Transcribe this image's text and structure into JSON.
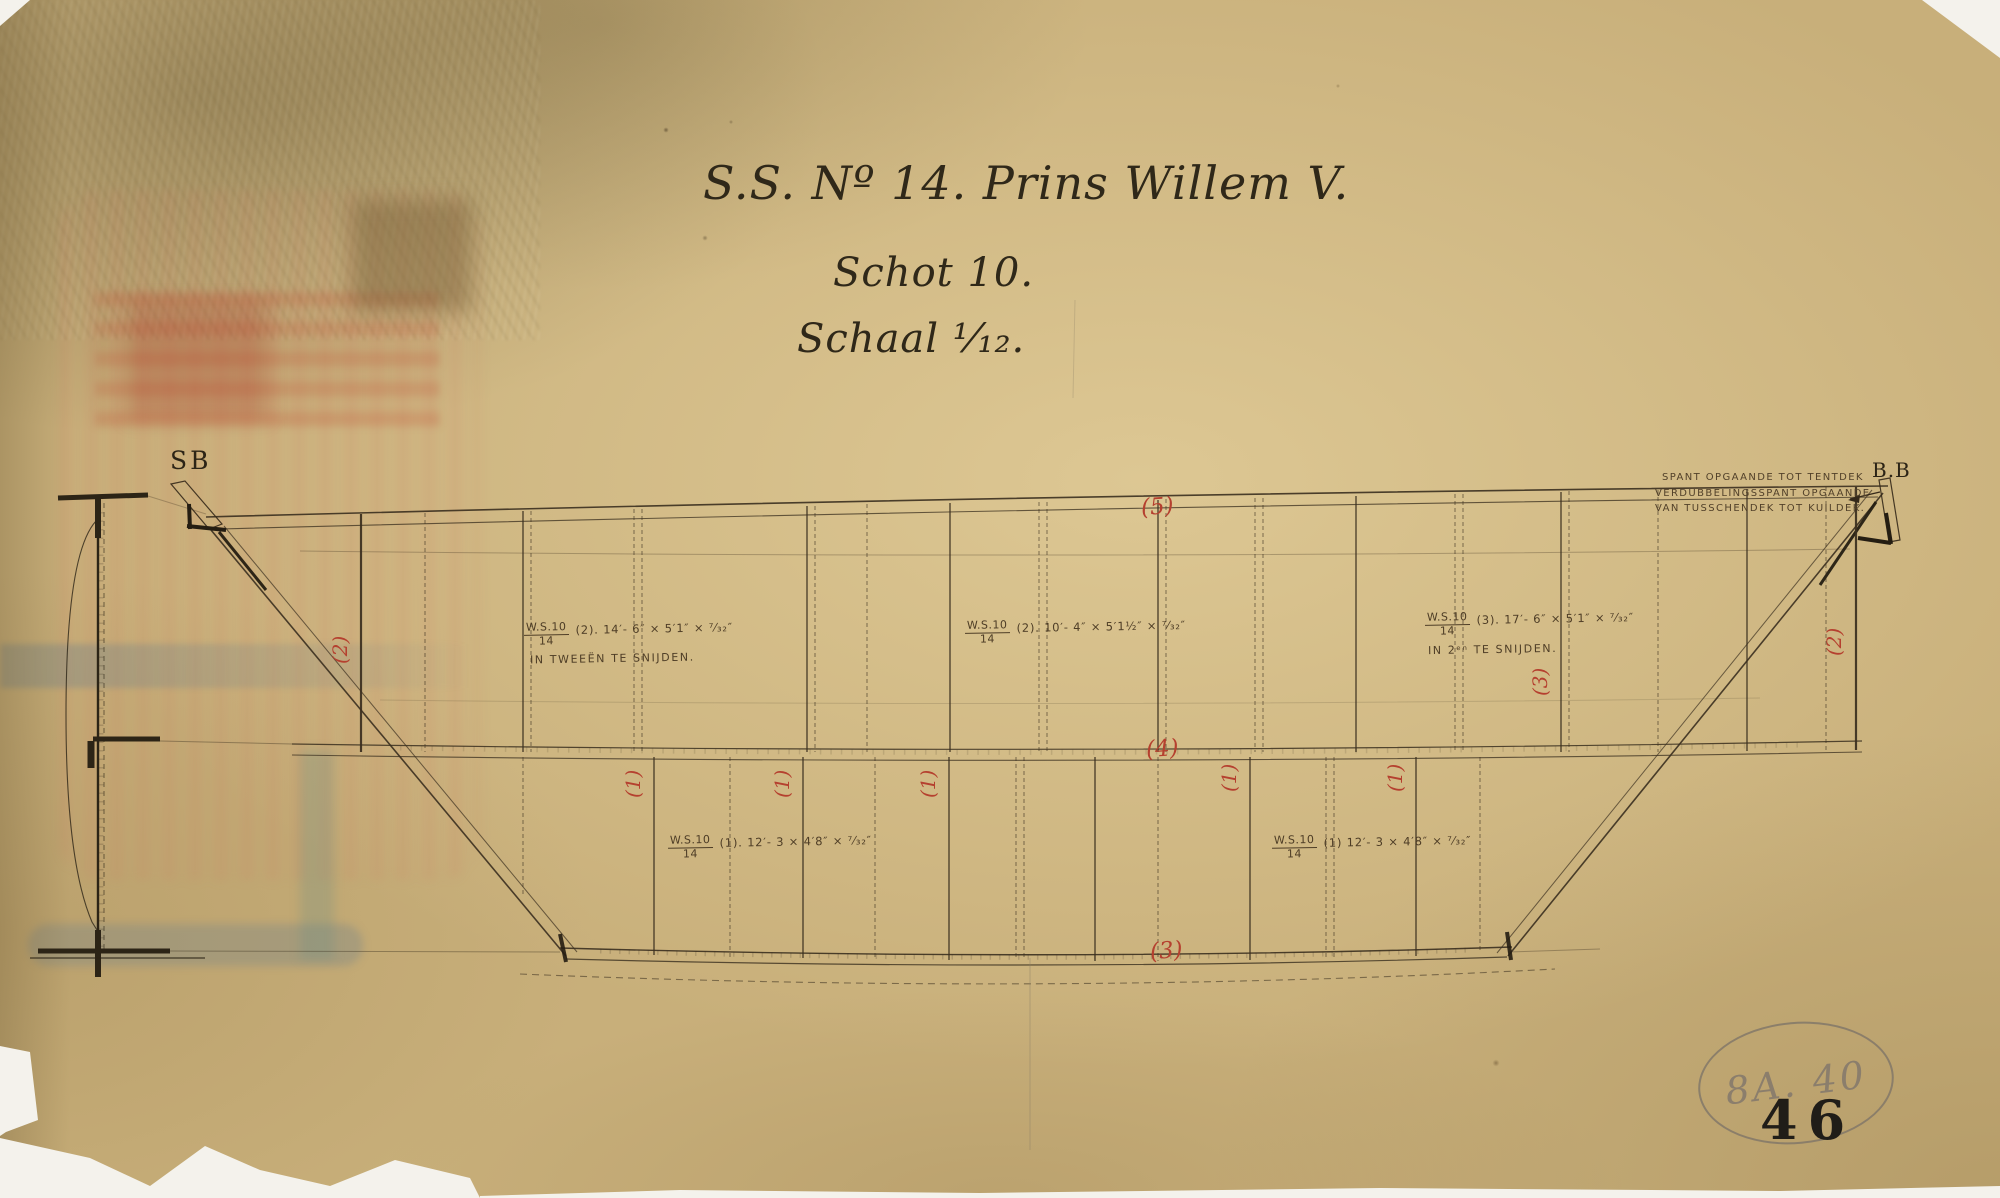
{
  "document": {
    "title_line1": "S.S. Nº 14. Prins Willem V.",
    "title_line2": "Schot 10.",
    "title_line3": "Schaal ¹⁄₁₂."
  },
  "side_labels": {
    "left": "SB",
    "right": "B.B"
  },
  "frame_note": {
    "line1": "SPANT OPGAANDE TOT TENTDEK",
    "line2": "VERDUBBELINGSSPANT OPGAANDE",
    "line3": "VAN TUSSCHENDEK TOT KUILDEK."
  },
  "plate_marks": [
    {
      "ref_top": "W.S.10",
      "ref_bottom": "14",
      "dims": "(2).  14′- 6″ × 5′1″ × ⁷⁄₃₂″",
      "note": "IN TWEEËN TE SNIJDEN."
    },
    {
      "ref_top": "W.S.10",
      "ref_bottom": "14",
      "dims": "(2).  10′- 4″ × 5′1½″ × ⁷⁄₃₂″",
      "note": ""
    },
    {
      "ref_top": "W.S.10",
      "ref_bottom": "14",
      "dims": "(3).  17′- 6″ × 5′1″ × ⁷⁄₃₂″",
      "note": "IN 2ᵉⁿ TE SNIJDEN."
    },
    {
      "ref_top": "W.S.10",
      "ref_bottom": "14",
      "dims": "(1).  12′- 3 × 4′8″ × ⁷⁄₃₂″",
      "note": ""
    },
    {
      "ref_top": "W.S.10",
      "ref_bottom": "14",
      "dims": "(1)  12′- 3 × 4′8″ × ⁷⁄₃₂″",
      "note": ""
    }
  ],
  "strake_numbers": {
    "top": "(5)",
    "middle": "(4)",
    "bottom": "(3)",
    "upper_left": "(2)",
    "upper_right": "(2)",
    "upper_right_inner": "(3)",
    "lower": [
      "(1)",
      "(1)",
      "(1)",
      "(1)",
      "(1)"
    ]
  },
  "stamps": {
    "archive_code": "8A. 40",
    "sheet_number": "46"
  },
  "colors": {
    "paper": "#c8af7a",
    "ink": "#3a2f1f",
    "red": "#b5402f",
    "pencil": "#8b7e6c",
    "stamp": "#201d18"
  }
}
